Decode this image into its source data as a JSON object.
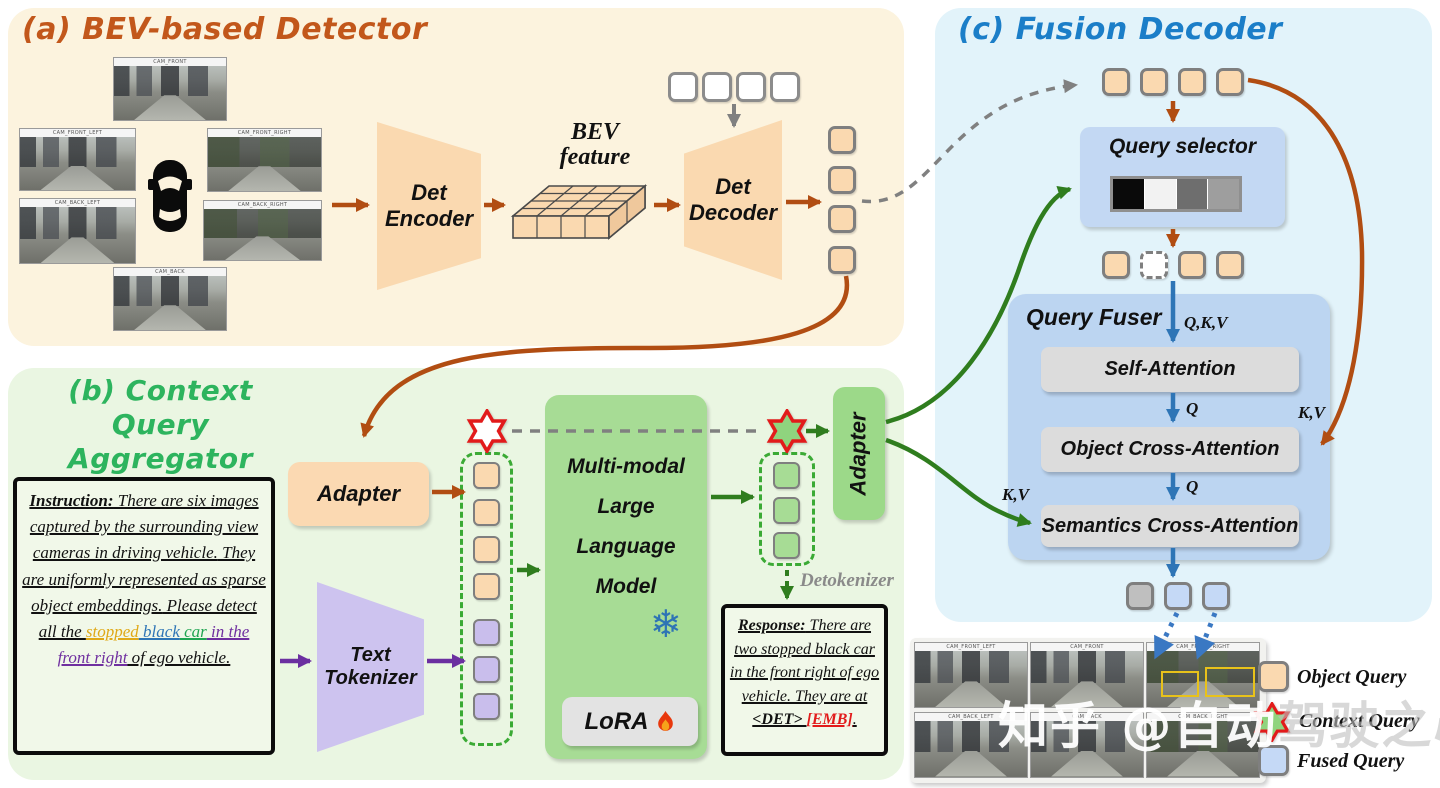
{
  "panel_a": {
    "title": "(a) BEV-based Detector",
    "cameras": [
      "CAM_FRONT",
      "CAM_FRONT_LEFT",
      "CAM_FRONT_RIGHT",
      "CAM_BACK_LEFT",
      "CAM_BACK_RIGHT",
      "CAM_BACK"
    ],
    "det_encoder": {
      "line1": "Det",
      "line2": "Encoder"
    },
    "bev_feature": {
      "line1": "BEV",
      "line2": "feature"
    },
    "det_decoder": {
      "line1": "Det",
      "line2": "Decoder"
    }
  },
  "panel_b": {
    "title": {
      "line1": "(b) Context Query",
      "line2": "Aggregator"
    },
    "instruction": {
      "i1": "Instruction:",
      "i2": " There are six images captured by the surrounding view cameras in driving vehicle.",
      "i3": " They are uniformly represented as sparse object embeddings.",
      "i4": " Please detect all the ",
      "i5": "stopped",
      "i6": " black",
      "i7": " car",
      "i8": " in the front right",
      "i9": " of ego vehicle."
    },
    "adapter_in": "Adapter",
    "text_tokenizer": {
      "line1": "Text",
      "line2": "Tokenizer"
    },
    "mllm": {
      "line1": "Multi-modal",
      "line2": "Large",
      "line3": "Language",
      "line4": "Model"
    },
    "lora": "LoRA",
    "adapter_out": "Adapter",
    "detokenizer": "Detokenizer",
    "response": {
      "r1": "Response:",
      "r2": " There are two stopped black car in the front right of ego vehicle. They are at ",
      "r3": "<DET>",
      "r4": " ",
      "r5": "[EMB]",
      "r6": "."
    }
  },
  "panel_c": {
    "title": "(c) Fusion Decoder",
    "query_selector": "Query selector",
    "query_fuser": "Query Fuser",
    "self_attention": "Self-Attention",
    "object_cross_attention": "Object Cross-Attention",
    "semantics_cross_attention": "Semantics Cross-Attention",
    "labels": {
      "qkv": "Q,K,V",
      "q_self": "Q",
      "q_obj": "Q",
      "kv_obj": "K,V",
      "kv_sem": "K,V"
    }
  },
  "legend": {
    "object_query": "Object Query",
    "context_query": "Context Query",
    "fused_query": "Fused Query"
  },
  "watermark": {
    "part1": "知乎 @自动",
    "part2": "驾驶之心"
  },
  "icons": {
    "snowflake": "❄"
  },
  "colors": {
    "orange_arrow": "#B14D12",
    "green_arrow": "#2F7D1E",
    "purple_arrow": "#6B2FA0",
    "blue_arrow": "#2E75B6",
    "gray_arrow": "#808080",
    "object_query_fill": "#FAD9B0",
    "text_token_fill": "#C9BEEC",
    "fused_query_fill": "#C5D9F6",
    "llm_green": "#A7DC95",
    "panel_a_bg": "#FCF3DE",
    "panel_b_bg": "#EAF6E2",
    "panel_c_bg": "#E2F3FA",
    "title_a": "#C2571B",
    "title_b": "#2DB45E",
    "title_c": "#1B7EC8",
    "emb_red": "#E21B1B"
  }
}
